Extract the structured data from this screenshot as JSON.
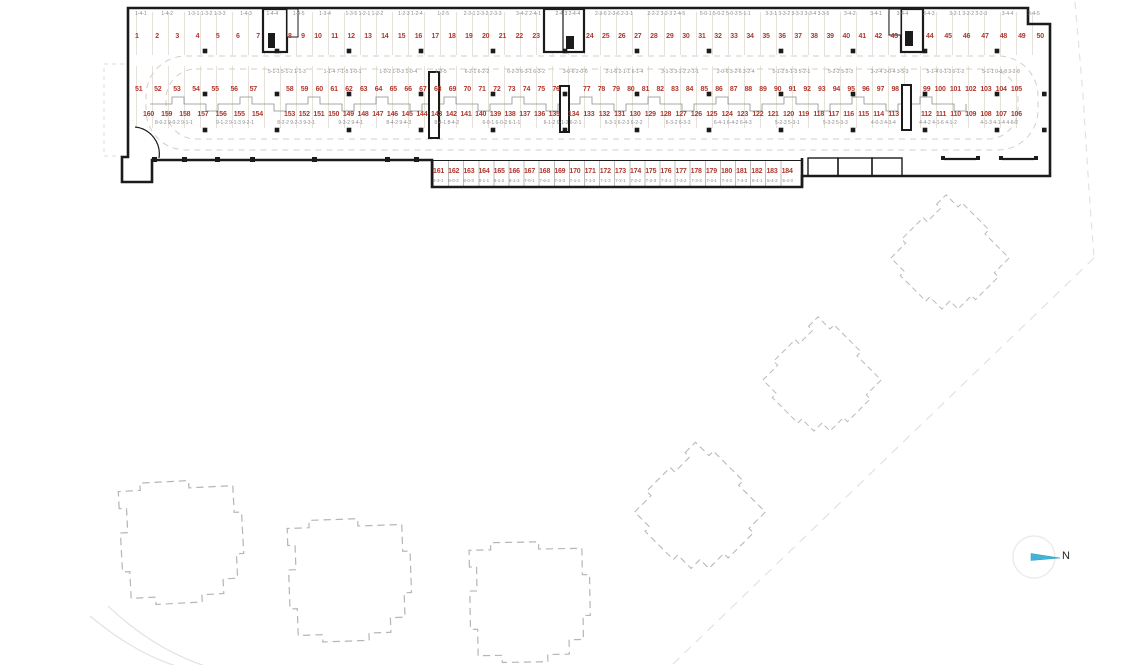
{
  "plan": {
    "north_label": "N",
    "colors": {
      "space_number": "#b0382d",
      "wall": "#1b1b1b",
      "lane_dash": "#d5cdc6",
      "building_dash": "#b6b6b6",
      "compass_needle": "#43b4d8"
    },
    "rows": {
      "top": {
        "codes": [
          "1-4-1",
          "1-4-2",
          "1-3-1 1-3-2 1-3-3",
          "1-4-3",
          "1-4-4",
          "1-4-5",
          "1-3-4",
          "1-3-5 1-2-1 1-2-2",
          "1-2-3 1-2-4",
          "1-2-5",
          "2-3-1 2-3-2 2-3-3",
          "3-4-2 2-4-1",
          "2-4-3 2-4-4",
          "2-3-6 2-3-6 2-3-1",
          "2-2-2 3-2-3 2-4-5",
          "5-0-1 5-0-2 5-0-3 5-1-1",
          "3-3-1 3-3-2 3-3-3 3-3-4 3-3-5",
          "3-4-2",
          "3-4-1",
          "3-4-4",
          "3-4-3",
          "3-2-1 3-2-2 3-2-3",
          "3-4-4",
          "3-4-5"
        ],
        "segments": [
          [
            1,
            2,
            3,
            4,
            5,
            6,
            7
          ],
          [
            8,
            9,
            10,
            11,
            12,
            13,
            14,
            15,
            16,
            17,
            18,
            19,
            20,
            21,
            22,
            23
          ],
          [
            24,
            25,
            26,
            27,
            28,
            29,
            30,
            31,
            32,
            33,
            34,
            35,
            36,
            37,
            38,
            39,
            40,
            41,
            42,
            43
          ],
          [
            44,
            45,
            46,
            47,
            48,
            49,
            50
          ]
        ]
      },
      "island_top": {
        "codes": [
          "5-1-1 5-1-2 1-1-3",
          "1-1-4 7-1-5 1-0-1",
          "1-0-2 1-0-3 1-0-4",
          "1-0-5",
          "6-2-1 6-2-2",
          "6-2-3 6-3-1 6-3-2",
          "3-0-6 2-0-6",
          "2-1-6 2-1-1 6-1-4",
          "3-1-3 3-1-2 2-1-1",
          "2-0-6 3-2-6 3-2-4",
          "5-1-2 5-1-3 5-2-1",
          "5-2-2 5-2-3",
          "3-2-4 3-0-4 3-5-3",
          "5-1-4 0-1-3 0-1-2",
          "5-1-1 0-3-8 3-2-8"
        ],
        "segments": [
          [
            51,
            52,
            53,
            54,
            55,
            56,
            57
          ],
          [
            58,
            59,
            60,
            61,
            62,
            63,
            64,
            65,
            66,
            67,
            68,
            69,
            70,
            71,
            72,
            73,
            74,
            75,
            76
          ],
          [
            77,
            78,
            79,
            80,
            81,
            82,
            83,
            84,
            85,
            86,
            87,
            88,
            89,
            90,
            91,
            92,
            93,
            94,
            95,
            96,
            97,
            98
          ],
          [
            99,
            100,
            101,
            102,
            103,
            104,
            105
          ]
        ]
      },
      "island_bottom": {
        "codes": [
          "8-0-2 9-0-2 9-1-1",
          "9-1-2 9-1-3 9-2-1",
          "8-2-2 9-2-3 9-3-1",
          "9-3-2 9-4-1",
          "8-4-2 9-4-3",
          "8-4-1 8-4-2",
          "6-0-1 6-0-2 6-1-1",
          "6-1-2 6-1-3 6-2-1",
          "6-3-1 6-2-3 6-2-2",
          "6-3-2 6-3-3",
          "6-4-1 6-4-2 6-4-3",
          "5-2-3 5-3-1",
          "5-3-2 5-3-3",
          "4-0-3 4-3-4",
          "4-4-2 4-1-6 4-1-2",
          "4-1-3 4-1-4 4-6-2"
        ],
        "segments": [
          [
            160,
            159,
            158,
            157,
            156,
            155,
            154
          ],
          [
            153,
            152,
            151,
            150,
            149,
            148,
            147,
            146,
            145,
            144,
            143,
            142,
            141,
            140,
            139,
            138,
            137,
            136,
            135
          ],
          [
            134,
            133,
            132,
            131,
            130,
            129,
            128,
            127,
            126,
            125,
            124,
            123,
            122,
            121,
            120,
            119,
            118,
            117,
            116,
            115,
            114,
            113
          ],
          [
            112,
            111,
            110,
            109,
            108,
            107,
            106
          ]
        ]
      },
      "bottom": {
        "codes": [
          "9-3-1",
          "8-0-2",
          "8-0-3",
          "8-1-1",
          "8-1-2",
          "8-1-3",
          "7-0-1",
          "7-6-2",
          "7-3-3",
          "7-1-1",
          "7-1-2",
          "7-1-3",
          "7-2-1",
          "7-2-2",
          "7-2-3",
          "7-3-1",
          "7-3-2",
          "7-3-3",
          "7-4-1",
          "7-4-2",
          "7-4-3",
          "5-4-1",
          "5-4-2",
          "5-4-3"
        ],
        "numbers": [
          161,
          162,
          163,
          164,
          165,
          166,
          167,
          168,
          169,
          170,
          171,
          172,
          173,
          174,
          175,
          176,
          177,
          178,
          179,
          180,
          181,
          182,
          183,
          184
        ]
      }
    }
  }
}
